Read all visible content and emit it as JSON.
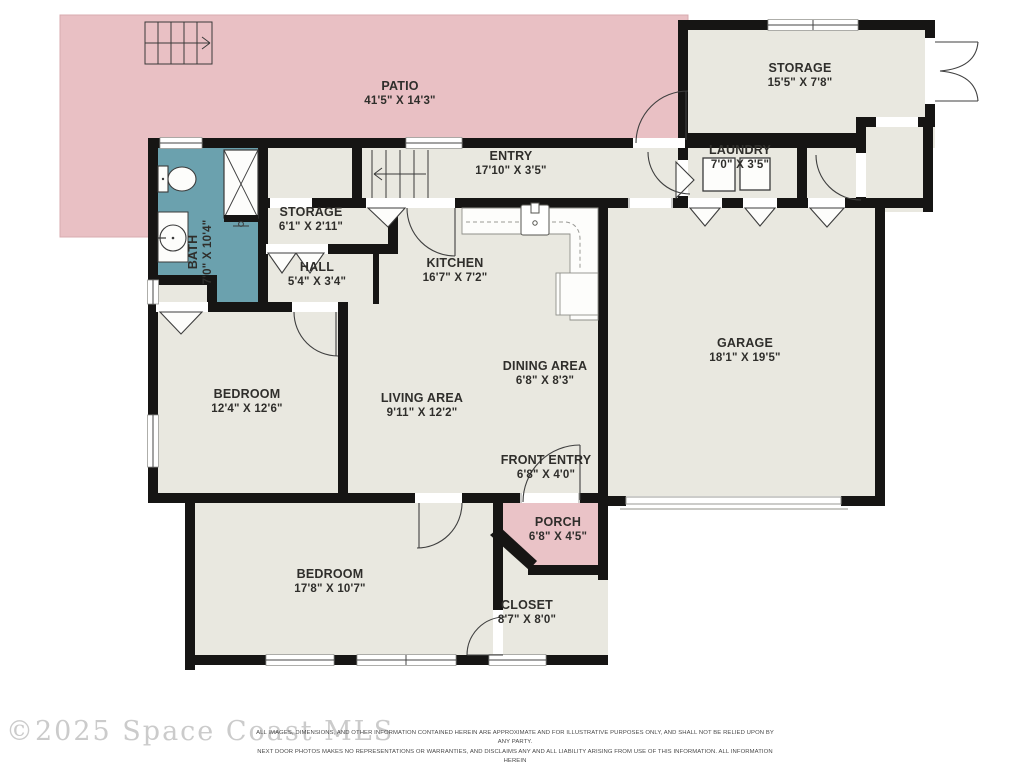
{
  "floorplan": {
    "colors": {
      "patio_pink": "#e9c0c4",
      "porch_pink": "#eac3c7",
      "bath_teal": "#6ba1ae",
      "room_beige": "#e9e8e0",
      "wall_black": "#161514",
      "fixture_white": "#fdfdfb",
      "garage_door_gray": "#b5b5b0"
    },
    "rooms": [
      {
        "id": "patio",
        "name": "PATIO",
        "dims": "41'5\" X 14'3\"",
        "x": 400,
        "y": 90
      },
      {
        "id": "storage-upper",
        "name": "STORAGE",
        "dims": "15'5\" X 7'8\"",
        "x": 800,
        "y": 72
      },
      {
        "id": "entry",
        "name": "ENTRY",
        "dims": "17'10\" X 3'5\"",
        "x": 511,
        "y": 160
      },
      {
        "id": "laundry",
        "name": "LAUNDRY",
        "dims": "7'0\" X 3'5\"",
        "x": 740,
        "y": 154
      },
      {
        "id": "bath",
        "name": "BATH",
        "dims": "7'0\" X 10'4\"",
        "x": 197,
        "y": 252,
        "rotate": -90
      },
      {
        "id": "storage-small",
        "name": "STORAGE",
        "dims": "6'1\" X 2'11\"",
        "x": 311,
        "y": 216
      },
      {
        "id": "hall",
        "name": "HALL",
        "dims": "5'4\" X 3'4\"",
        "x": 317,
        "y": 271
      },
      {
        "id": "kitchen",
        "name": "KITCHEN",
        "dims": "16'7\" X 7'2\"",
        "x": 455,
        "y": 267
      },
      {
        "id": "garage",
        "name": "GARAGE",
        "dims": "18'1\" X 19'5\"",
        "x": 745,
        "y": 347
      },
      {
        "id": "dining-area",
        "name": "DINING AREA",
        "dims": "6'8\" X 8'3\"",
        "x": 545,
        "y": 370
      },
      {
        "id": "living-area",
        "name": "LIVING AREA",
        "dims": "9'11\" X 12'2\"",
        "x": 422,
        "y": 402
      },
      {
        "id": "bedroom-1",
        "name": "BEDROOM",
        "dims": "12'4\" X 12'6\"",
        "x": 247,
        "y": 398
      },
      {
        "id": "front-entry",
        "name": "FRONT ENTRY",
        "dims": "6'8\" X 4'0\"",
        "x": 546,
        "y": 464
      },
      {
        "id": "porch",
        "name": "PORCH",
        "dims": "6'8\" X 4'5\"",
        "x": 558,
        "y": 526
      },
      {
        "id": "bedroom-2",
        "name": "BEDROOM",
        "dims": "17'8\" X 10'7\"",
        "x": 330,
        "y": 578
      },
      {
        "id": "closet",
        "name": "CLOSET",
        "dims": "8'7\" X 8'0\"",
        "x": 527,
        "y": 609
      }
    ]
  },
  "watermark": {
    "text": "©2025 Space Coast MLS"
  },
  "disclaimer": {
    "line1": "ALL IMAGES, DIMENSIONS, AND OTHER INFORMATION CONTAINED HEREIN ARE APPROXIMATE AND FOR ILLUSTRATIVE PURPOSES ONLY, AND SHALL NOT BE RELIED UPON BY ANY PARTY.",
    "line2": "NEXT DOOR PHOTOS MAKES NO REPRESENTATIONS OR WARRANTIES, AND DISCLAIMS ANY AND ALL LIABILITY ARISING FROM USE OF THIS INFORMATION. ALL INFORMATION HEREIN",
    "line3": "SHALL BE SUBJECT TO THE TERMS AND CONDITIONS FOUND AT NEXTDOORPHOTOS.COM/TC."
  }
}
